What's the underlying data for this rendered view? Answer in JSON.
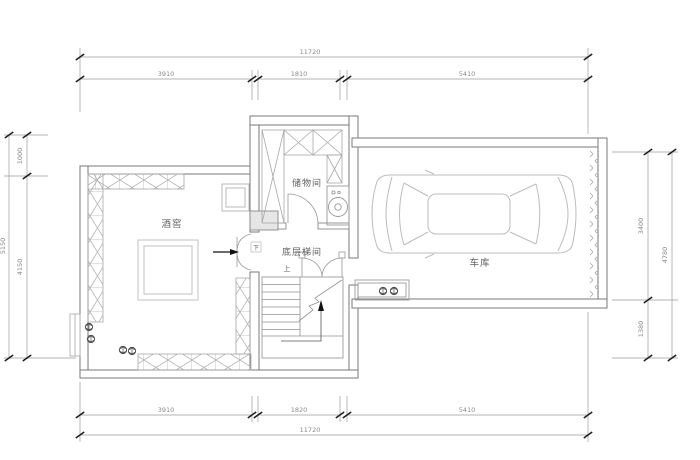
{
  "drawing": {
    "type": "architectural-floor-plan",
    "rooms": {
      "wine_cellar": "酒窖",
      "storage": "储物间",
      "stairwell": "底层梯间",
      "garage": "车库",
      "up": "上",
      "down": "下"
    },
    "dimensions": {
      "top": {
        "total": "11720",
        "segments": [
          "3910",
          "1810",
          "5410"
        ]
      },
      "bottom": {
        "total": "11720",
        "segments": [
          "3910",
          "1820",
          "5410"
        ]
      },
      "left": {
        "total": "5150",
        "segments": [
          "1000",
          "4150"
        ]
      },
      "right": {
        "total": "4780",
        "segments": [
          "3400",
          "1380"
        ]
      }
    },
    "colors": {
      "background": "#ffffff",
      "wall": "#7a7a7a",
      "dim_line": "#9a9a9a",
      "dim_tick": "#1c1c1c",
      "hatch": "#b3b3b3",
      "furniture": "#b8b8b8",
      "text": "#5f5f5f",
      "arrow": "#111111"
    }
  }
}
